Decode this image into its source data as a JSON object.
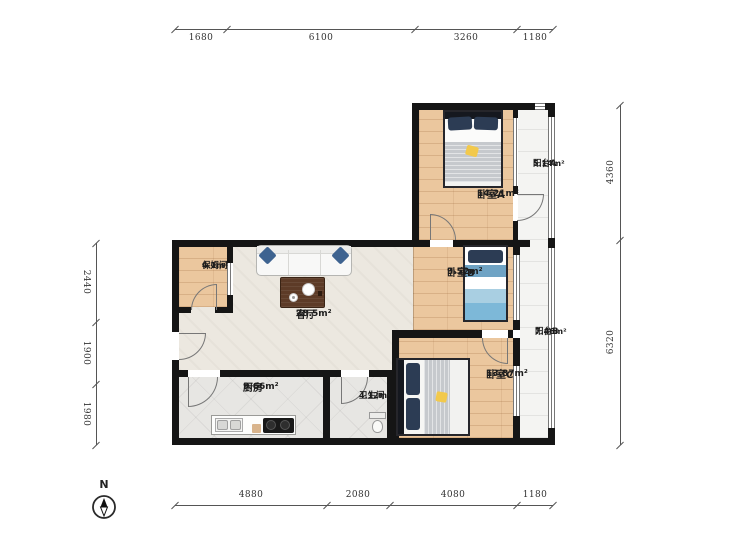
{
  "compass": {
    "label": "N"
  },
  "dimensions": {
    "top": [
      "1680",
      "6100",
      "3260",
      "1180"
    ],
    "bottom": [
      "4880",
      "2080",
      "4080",
      "1180"
    ],
    "left": [
      "2440",
      "1900",
      "1980"
    ],
    "right": [
      "4360",
      "6320"
    ]
  },
  "rooms": [
    {
      "id": "living",
      "name": "客厅",
      "area": "28.5m²"
    },
    {
      "id": "nanny",
      "name": "保姆间",
      "area": "4.1m²"
    },
    {
      "id": "kitchen",
      "name": "厨房",
      "area": "9.66m²"
    },
    {
      "id": "bathroom",
      "name": "卫生间",
      "area": "4.12m²"
    },
    {
      "id": "bedroomA",
      "name": "卧室A",
      "area": "14.21m²"
    },
    {
      "id": "balconyA",
      "name": "阳台A",
      "area": "5.14m²"
    },
    {
      "id": "bedroomB",
      "name": "卧室B",
      "area": "9.52m²"
    },
    {
      "id": "balconyB",
      "name": "阳台B",
      "area": "7.46m²"
    },
    {
      "id": "bedroomC",
      "name": "卧室C",
      "area": "13.87m²"
    }
  ],
  "colors": {
    "wall": "#151515",
    "wood": "#ebc79e",
    "living": "#ece8e0",
    "tile": "#e7e6e3",
    "balcony": "#f4f4f2",
    "windowline": "#777777",
    "doorline": "#777777",
    "dimline": "#555555",
    "labeltext": "#1d1d1d",
    "navy": "#2c3c54",
    "blue": "#7db8d8",
    "bluedeep": "#6fa3c4",
    "bluelight": "#a9cfe2",
    "sofapillow": "#3e6390",
    "tabletop": "#5d3b27",
    "blanket": "#c6c9cd",
    "yellow": "#f2c94c"
  }
}
